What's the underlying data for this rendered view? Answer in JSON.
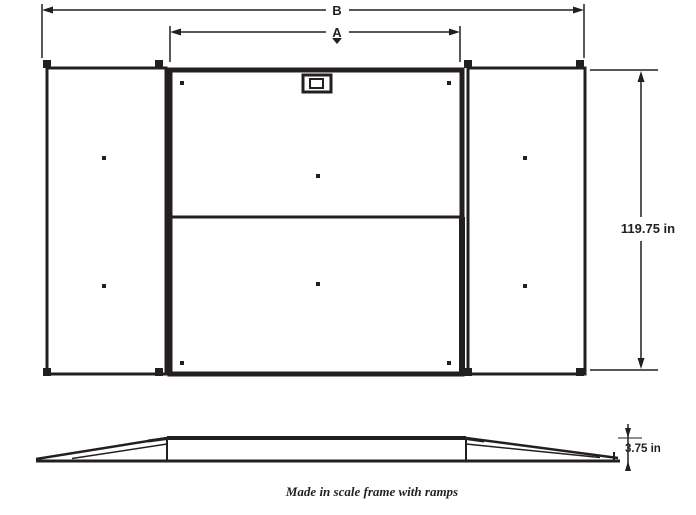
{
  "page": {
    "background_color": "#ffffff",
    "ink_color": "#231f20"
  },
  "top_view": {
    "dim_overall_width_label": "B",
    "dim_platform_width_label": "A",
    "dim_depth_label": "119.75 in"
  },
  "side_view": {
    "dim_height_label": "3.75 in"
  },
  "caption": "Made in scale frame with ramps"
}
